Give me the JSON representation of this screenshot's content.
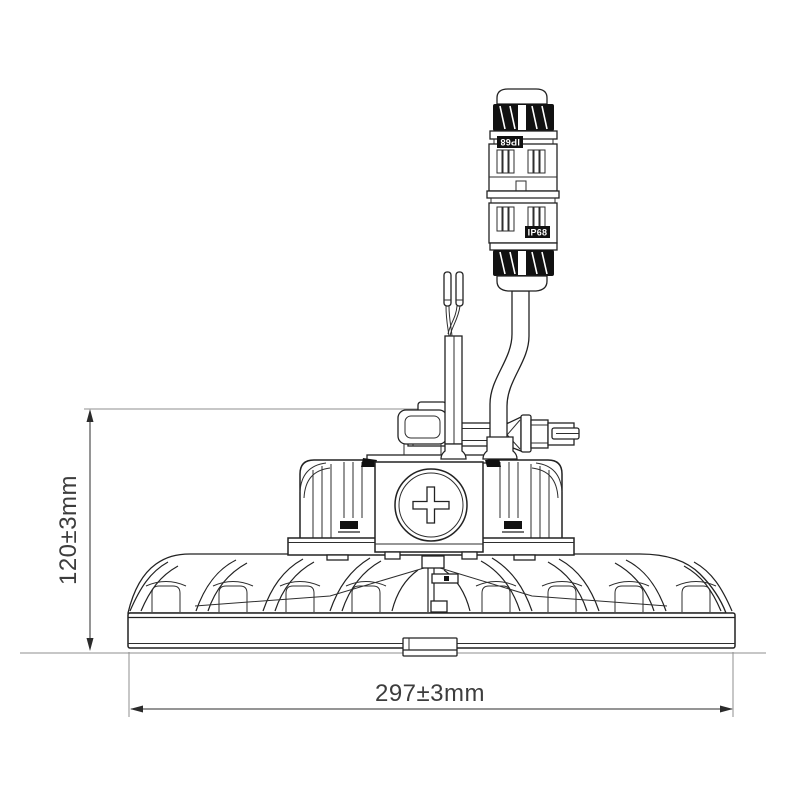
{
  "dimensions": {
    "height": {
      "label": "120±3mm"
    },
    "width": {
      "label": "297±3mm"
    }
  },
  "connector": {
    "label_top": "IP68",
    "label_bottom": "IP68"
  },
  "colors": {
    "background": "#ffffff",
    "line": "#222222",
    "extension_line": "#8f8f8f",
    "dimension_text": "#3d3d3d",
    "black_fill": "#111111"
  }
}
